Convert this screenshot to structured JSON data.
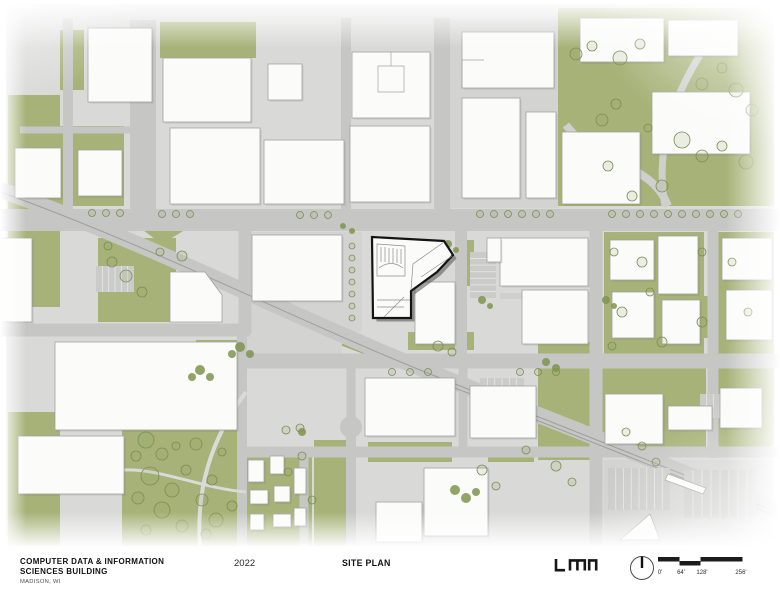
{
  "titleblock": {
    "project_title_line1": "COMPUTER DATA & INFORMATION",
    "project_title_line2": "SCIENCES BUILDING",
    "location": "MADISON, WI",
    "year": "2022",
    "sheet_title": "SITE PLAN",
    "firm": "LMN"
  },
  "scale_bar": {
    "labels": [
      "0'",
      "64'",
      "128'",
      "256'"
    ]
  },
  "map": {
    "colors": {
      "base": "#d9dad8",
      "road": "#c6c7c5",
      "light": "#cfd0ce",
      "path": "#dadbd9",
      "rail": "#9e9e9c",
      "green": "#a6b277",
      "median": "#9cab6b",
      "dark": "#7e9150",
      "building": "#fbfbfa",
      "bstroke": "#a2a2a0",
      "bshadow": "rgba(60,60,58,0.10)",
      "tree": "#7c8c55",
      "tree_fill": "rgba(150,165,100,0.16)",
      "shrub": "#7e944e",
      "parking": "#cbccca",
      "stripe": "#e8e8e6",
      "plaza": "#d3d4d2",
      "hl_stroke": "#141414",
      "hl_shadow": "rgba(70,70,68,0.5)",
      "detail": "#8d8d8b"
    },
    "greens": [
      [
        8,
        95,
        52,
        212
      ],
      [
        60,
        126,
        64,
        80
      ],
      [
        160,
        22,
        96,
        36
      ],
      [
        60,
        30,
        24,
        60
      ],
      [
        558,
        8,
        216,
        198
      ],
      [
        448,
        120,
        40,
        42
      ],
      [
        448,
        166,
        30,
        38
      ],
      [
        98,
        238,
        78,
        84
      ],
      [
        604,
        232,
        100,
        122
      ],
      [
        716,
        232,
        58,
        122
      ],
      [
        600,
        362,
        106,
        86
      ],
      [
        712,
        358,
        62,
        90
      ],
      [
        122,
        418,
        124,
        128
      ],
      [
        8,
        412,
        52,
        134
      ],
      [
        244,
        452,
        68,
        94
      ],
      [
        314,
        440,
        32,
        106
      ],
      [
        538,
        342,
        54,
        118
      ],
      [
        408,
        332,
        66,
        18
      ],
      [
        460,
        240,
        14,
        46
      ],
      [
        136,
        32,
        5,
        168,
        "median"
      ],
      [
        146,
        32,
        5,
        168,
        "median"
      ],
      [
        680,
        296,
        28,
        42
      ],
      [
        488,
        448,
        46,
        14
      ],
      [
        368,
        442,
        84,
        20
      ]
    ],
    "green_polys": [
      {
        "pts": "256,304 310,326 308,332 254,310",
        "fill": "median"
      },
      {
        "pts": "318,330 424,371 422,376 316,336",
        "fill": "median"
      },
      {
        "pts": "140,228 188,228 162,244"
      },
      {
        "pts": "122,418 246,388 246,418"
      },
      {
        "pts": "196,340 240,340 240,374 196,374"
      },
      {
        "pts": "452,484 488,488 462,514",
        "fill": "dark"
      }
    ],
    "plazas": [
      [
        446,
        20,
        112,
        188
      ],
      [
        340,
        232,
        22,
        100
      ],
      [
        244,
        232,
        98,
        122
      ],
      [
        604,
        460,
        170,
        86
      ]
    ],
    "roads": [
      {
        "d": "M-5,188 C150,243 300,320 430,372 C520,408 660,462 790,516",
        "w": 16
      },
      {
        "d": "M0,220 L780,220",
        "w": 22
      },
      {
        "d": "M143,20 L143,210",
        "w": 26
      },
      {
        "d": "M346,18 L346,210",
        "w": 10
      },
      {
        "d": "M442,18 L442,210",
        "w": 16
      },
      {
        "d": "M68,18 L68,210",
        "w": 10
      },
      {
        "d": "M20,130 L140,130",
        "w": 7
      },
      {
        "d": "M0,330 L250,330",
        "w": 13
      },
      {
        "d": "M245,209 L245,334",
        "w": 13
      },
      {
        "d": "M238,361 L780,361",
        "w": 15
      },
      {
        "d": "M596,209 L596,546",
        "w": 13
      },
      {
        "d": "M713,209 L713,458",
        "w": 11
      },
      {
        "d": "M240,452 L780,452",
        "w": 11
      },
      {
        "d": "M242,330 L242,546",
        "w": 10
      },
      {
        "d": "M351,366 L351,434",
        "w": 9
      },
      {
        "d": "M351,434 L351,546",
        "w": 10
      },
      {
        "d": "M304,452 L304,546",
        "w": 9
      },
      {
        "d": "M461,209 L461,362",
        "w": 12
      },
      {
        "d": "M463,366 L463,455",
        "w": 9
      },
      {
        "d": "M566,125 C600,170 650,160 668,206",
        "w": 8,
        "c": "light"
      },
      {
        "d": "M700,55 C672,100 655,150 665,206",
        "w": 7,
        "c": "light"
      },
      {
        "d": "M500,296 L588,296",
        "w": 6,
        "c": "light"
      },
      {
        "d": "M246,392 C210,440 196,490 200,546",
        "w": 4,
        "c": "path"
      },
      {
        "d": "M122,470 C160,468 200,488 246,492",
        "w": 3,
        "c": "path"
      }
    ],
    "circles": [
      {
        "cx": 351,
        "cy": 427,
        "r": 11
      }
    ],
    "rails": [
      {
        "d": "M-5,190 C150,245 300,322 430,374 C520,410 660,464 790,518"
      },
      {
        "d": "M430,378 C520,414 660,468 790,522"
      }
    ],
    "parkings": [
      [
        96,
        266,
        38,
        26,
        6,
        "v"
      ],
      [
        470,
        252,
        26,
        46,
        7,
        "h"
      ],
      [
        608,
        468,
        62,
        42,
        8,
        "v"
      ],
      [
        684,
        470,
        72,
        48,
        8,
        "v"
      ],
      [
        700,
        394,
        40,
        24,
        6,
        "v"
      ],
      [
        480,
        378,
        44,
        22,
        6,
        "v"
      ]
    ],
    "buildings": [
      [
        88,
        28,
        64,
        74
      ],
      [
        163,
        58,
        88,
        64
      ],
      [
        170,
        128,
        90,
        76
      ],
      [
        264,
        140,
        80,
        64
      ],
      [
        268,
        64,
        34,
        36
      ],
      [
        352,
        52,
        78,
        66
      ],
      [
        350,
        126,
        80,
        76
      ],
      [
        15,
        148,
        46,
        50
      ],
      [
        78,
        150,
        44,
        46
      ],
      [
        462,
        32,
        92,
        56
      ],
      [
        462,
        98,
        58,
        100
      ],
      [
        526,
        112,
        30,
        86
      ],
      [
        580,
        18,
        84,
        44
      ],
      [
        668,
        20,
        70,
        36
      ],
      [
        562,
        132,
        78,
        72
      ],
      [
        652,
        92,
        98,
        62
      ],
      [
        0,
        238,
        32,
        84
      ],
      [
        252,
        235,
        90,
        66
      ],
      [
        415,
        282,
        40,
        62
      ],
      [
        500,
        238,
        88,
        48
      ],
      [
        522,
        290,
        66,
        54
      ],
      [
        487,
        238,
        14,
        24
      ],
      [
        610,
        240,
        44,
        40
      ],
      [
        658,
        236,
        40,
        58
      ],
      [
        612,
        292,
        42,
        46
      ],
      [
        662,
        300,
        38,
        44
      ],
      [
        722,
        238,
        50,
        42
      ],
      [
        726,
        290,
        46,
        50
      ],
      [
        55,
        342,
        182,
        88
      ],
      [
        18,
        436,
        106,
        58
      ],
      [
        248,
        460,
        16,
        22
      ],
      [
        270,
        456,
        14,
        18
      ],
      [
        250,
        490,
        18,
        14
      ],
      [
        274,
        486,
        16,
        16
      ],
      [
        250,
        514,
        14,
        16
      ],
      [
        273,
        514,
        18,
        13
      ],
      [
        294,
        468,
        12,
        26
      ],
      [
        294,
        508,
        12,
        18
      ],
      [
        365,
        378,
        90,
        58
      ],
      [
        470,
        386,
        66,
        52
      ],
      [
        376,
        502,
        46,
        40
      ],
      [
        424,
        468,
        64,
        68
      ],
      [
        605,
        394,
        58,
        50
      ],
      [
        668,
        406,
        44,
        24
      ],
      [
        720,
        388,
        42,
        40
      ]
    ],
    "bpolys": [
      {
        "pts": "170,272 205,272 222,295 222,322 170,322"
      },
      {
        "pts": "620,540 650,514 660,540"
      },
      {
        "pts": "668,474 706,488 703,494 665,480"
      }
    ],
    "inner_lines": [
      "M378,66 h26 v26 h-26 Z",
      "M391,52 v14",
      "M484,60 h-22 v28"
    ],
    "trees": [
      [
        92,
        213,
        3.5
      ],
      [
        106,
        213,
        3.5
      ],
      [
        120,
        213,
        3.5
      ],
      [
        162,
        214,
        3.5
      ],
      [
        176,
        214,
        3.5
      ],
      [
        190,
        214,
        3.5
      ],
      [
        300,
        215,
        3.5
      ],
      [
        314,
        215,
        3.5
      ],
      [
        328,
        215,
        3.5
      ],
      [
        480,
        214,
        3.5
      ],
      [
        494,
        214,
        3.5
      ],
      [
        508,
        214,
        3.5
      ],
      [
        522,
        214,
        3.5
      ],
      [
        536,
        214,
        3.5
      ],
      [
        550,
        214,
        3.5
      ],
      [
        612,
        214,
        3.5
      ],
      [
        626,
        214,
        3.5
      ],
      [
        640,
        214,
        3.5
      ],
      [
        654,
        214,
        3.5
      ],
      [
        668,
        214,
        3.5
      ],
      [
        682,
        214,
        3.5
      ],
      [
        696,
        214,
        3.5
      ],
      [
        710,
        214,
        3.5
      ],
      [
        724,
        214,
        3.5
      ],
      [
        738,
        214,
        3.5
      ],
      [
        576,
        54,
        6
      ],
      [
        592,
        46,
        5
      ],
      [
        620,
        58,
        7
      ],
      [
        640,
        44,
        5
      ],
      [
        702,
        84,
        6
      ],
      [
        722,
        68,
        5
      ],
      [
        736,
        90,
        7
      ],
      [
        752,
        110,
        6
      ],
      [
        682,
        140,
        8
      ],
      [
        702,
        156,
        6
      ],
      [
        722,
        146,
        5
      ],
      [
        746,
        162,
        7
      ],
      [
        602,
        120,
        6
      ],
      [
        616,
        104,
        5
      ],
      [
        662,
        186,
        6
      ],
      [
        632,
        196,
        5
      ],
      [
        608,
        166,
        5
      ],
      [
        648,
        128,
        4
      ],
      [
        146,
        440,
        8
      ],
      [
        162,
        454,
        6
      ],
      [
        150,
        476,
        9
      ],
      [
        172,
        490,
        7
      ],
      [
        186,
        470,
        5
      ],
      [
        162,
        510,
        8
      ],
      [
        182,
        526,
        6
      ],
      [
        146,
        530,
        5
      ],
      [
        202,
        500,
        6
      ],
      [
        212,
        480,
        5
      ],
      [
        196,
        444,
        6
      ],
      [
        216,
        520,
        7
      ],
      [
        232,
        506,
        5
      ],
      [
        176,
        446,
        4
      ],
      [
        222,
        452,
        4
      ],
      [
        206,
        534,
        5
      ],
      [
        136,
        456,
        5
      ],
      [
        138,
        498,
        6
      ],
      [
        352,
        246,
        3
      ],
      [
        352,
        258,
        3
      ],
      [
        352,
        270,
        3
      ],
      [
        352,
        282,
        3
      ],
      [
        352,
        294,
        3
      ],
      [
        352,
        306,
        3
      ],
      [
        352,
        318,
        3
      ],
      [
        392,
        372,
        3.5
      ],
      [
        410,
        372,
        3.5
      ],
      [
        428,
        372,
        3.5
      ],
      [
        520,
        372,
        3.5
      ],
      [
        538,
        372,
        3.5
      ],
      [
        556,
        372,
        3.5
      ],
      [
        614,
        252,
        4
      ],
      [
        642,
        262,
        5
      ],
      [
        650,
        292,
        4
      ],
      [
        622,
        312,
        5
      ],
      [
        702,
        252,
        4
      ],
      [
        732,
        262,
        4
      ],
      [
        702,
        322,
        5
      ],
      [
        748,
        312,
        4
      ],
      [
        662,
        342,
        5
      ],
      [
        612,
        346,
        4
      ],
      [
        112,
        262,
        5
      ],
      [
        126,
        276,
        6
      ],
      [
        142,
        292,
        5
      ],
      [
        160,
        252,
        4
      ],
      [
        182,
        256,
        5
      ],
      [
        108,
        246,
        4
      ],
      [
        302,
        456,
        4
      ],
      [
        288,
        472,
        4
      ],
      [
        312,
        500,
        4
      ],
      [
        482,
        470,
        5
      ],
      [
        496,
        486,
        4
      ],
      [
        526,
        450,
        4
      ],
      [
        556,
        466,
        5
      ],
      [
        572,
        482,
        4
      ],
      [
        626,
        432,
        4
      ],
      [
        642,
        446,
        4
      ],
      [
        656,
        462,
        4
      ],
      [
        438,
        346,
        5
      ],
      [
        452,
        352,
        4
      ],
      [
        300,
        428,
        4
      ],
      [
        286,
        430,
        4
      ]
    ],
    "shrubs": [
      [
        200,
        370,
        5
      ],
      [
        210,
        377,
        4
      ],
      [
        192,
        377,
        4
      ],
      [
        482,
        300,
        4
      ],
      [
        490,
        306,
        3
      ],
      [
        302,
        432,
        4
      ],
      [
        455,
        490,
        5
      ],
      [
        466,
        498,
        5
      ],
      [
        476,
        492,
        4
      ],
      [
        343,
        226,
        3
      ],
      [
        352,
        231,
        3
      ],
      [
        240,
        347,
        5
      ],
      [
        250,
        354,
        4
      ],
      [
        232,
        354,
        4
      ],
      [
        546,
        362,
        4
      ],
      [
        556,
        368,
        4
      ],
      [
        448,
        244,
        4
      ],
      [
        456,
        250,
        3
      ],
      [
        606,
        300,
        4
      ],
      [
        614,
        306,
        3
      ]
    ],
    "highlight": {
      "shadow": "M375.5,240.5 L447.5,244.5 L456.5,258.5 L440.5,275.5 L414.5,294.5 L414.5,321.5 L376.5,321.5 Z",
      "outline": "M372,237 L444,241 L453,255 L437,272 L411,291 L411,318 L373,318 Z",
      "details": [
        "M377,244 L405,246 L405,276 L377,276 Z",
        "M381,247 L381,262",
        "M385,247 L385,262",
        "M389,248 L389,263",
        "M393,248 L393,263",
        "M397,249 L397,263",
        "M401,249 L401,264",
        "M379,268 Q391,259 403,268",
        "M444,242 L413,264 L411,290",
        "M452,256 L421,277",
        "M377,300 L410,300",
        "M377,307 L404,307",
        "M384,317 L404,297"
      ]
    }
  }
}
